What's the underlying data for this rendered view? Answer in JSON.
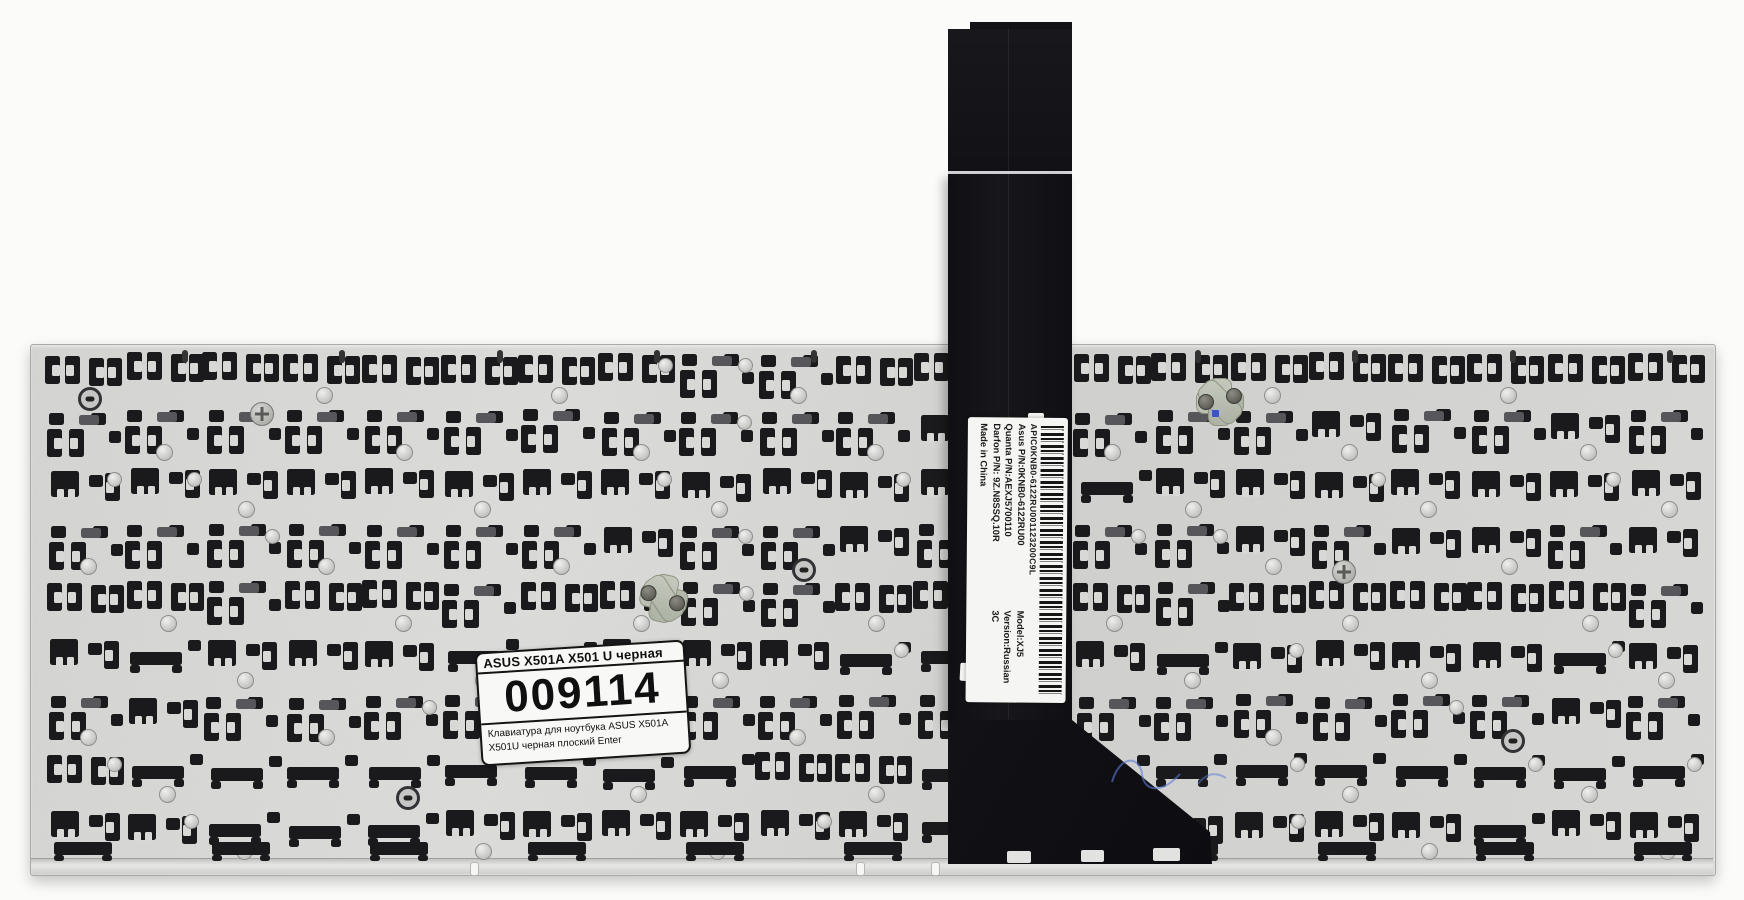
{
  "scene": {
    "description": "Rear view photo of a replacement laptop keyboard for ASUS X501A / X501U: aluminium backplate with rows of black key-retainer clips, a black ribbon cable running upward with a vertical part-number label and barcode, and a white seller label with item code.",
    "background_color": "#fbfbfa"
  },
  "colors": {
    "bg": "#fbfbfa",
    "plate": "#d8d8d6",
    "plate-edge": "#a9a9a7",
    "clip": "#1a1a1c",
    "clip-gray": "#56565b",
    "ribbon": "#131317",
    "label-bg": "#f5f5f3",
    "label-text": "#1a1a1a",
    "blue": "#5a79d6"
  },
  "ribbon_label": {
    "serial_line": "APIC0KNB0-6122RU001123200C9L",
    "rows": [
      {
        "left": "Asus P/N:0KNB0-6122RU00",
        "right": "Model:XJ5"
      },
      {
        "left": "Quanta P/N:AEXJ5700110",
        "right": "Version:Russian"
      },
      {
        "left": "Darfon P/N: 9Z.N8SSQ.10R",
        "right": "3C"
      },
      {
        "left": "Made in China",
        "right": ""
      }
    ]
  },
  "product_label": {
    "title": "ASUS X501A X501 U черная",
    "code": "009114",
    "description_line1": "Клавиатура для ноутбука ASUS X501A",
    "description_line2": "X501U черная плоский Enter"
  },
  "pattern": {
    "seed": 7,
    "x0": 46,
    "y0": 354,
    "cell_w": 79,
    "row_h": 57,
    "cols": 21,
    "rows": 9,
    "top_slot_xs": [
      182,
      339,
      497,
      654,
      811,
      1195,
      1352,
      1510,
      1667
    ],
    "lip_slot_xs": [
      470,
      856,
      931
    ],
    "phillips_screws": [
      [
        250,
        402
      ],
      [
        1332,
        560
      ]
    ],
    "fan_notches": [
      [
        1007,
        851,
        24,
        12
      ],
      [
        1081,
        850,
        23,
        12
      ],
      [
        1153,
        848,
        27,
        13
      ]
    ]
  }
}
